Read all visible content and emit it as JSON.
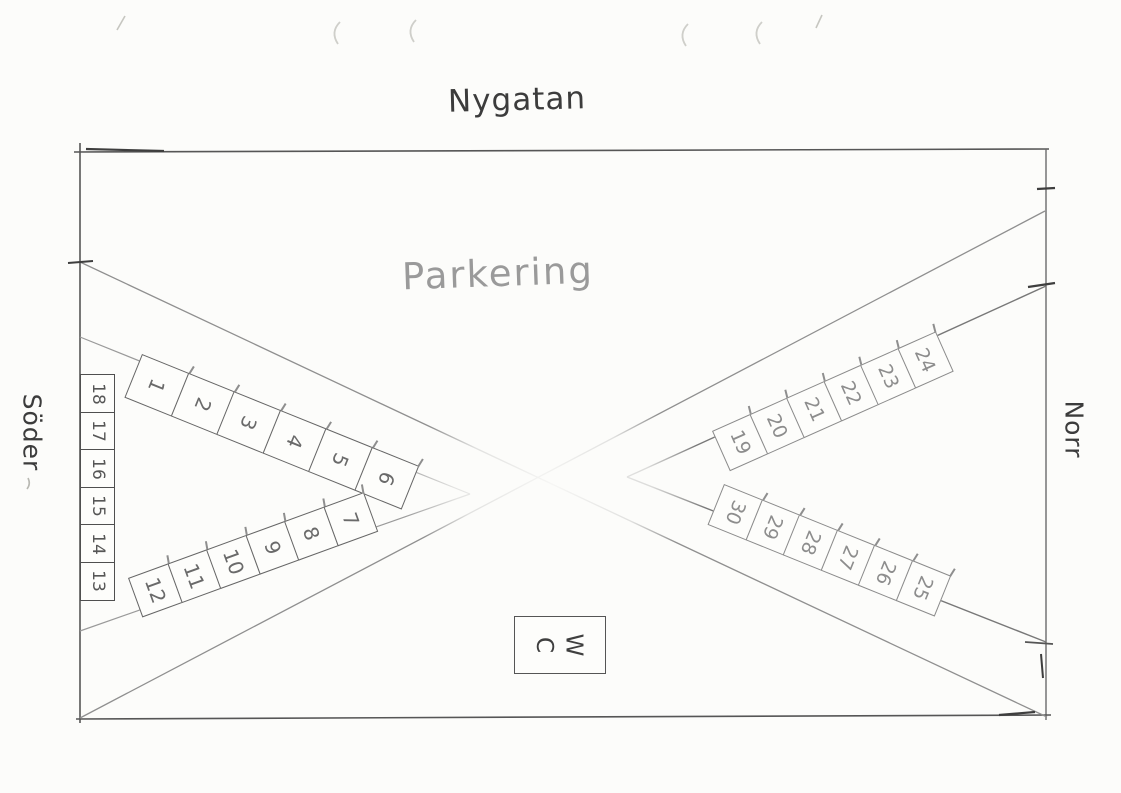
{
  "labels": {
    "street_top": "Nygatan",
    "area_center": "Parkering",
    "side_left": "Söder",
    "side_right": "Norr"
  },
  "wc_sign": {
    "letters": [
      "W",
      "C"
    ]
  },
  "parking_spaces": {
    "upper_left_row": [
      "1",
      "2",
      "3",
      "4",
      "5",
      "6"
    ],
    "lower_left_row": [
      "12",
      "11",
      "10",
      "9",
      "8",
      "7"
    ],
    "left_column": [
      "18",
      "17",
      "16",
      "15",
      "14",
      "13"
    ],
    "upper_right_row": [
      "19",
      "20",
      "21",
      "22",
      "23",
      "24"
    ],
    "lower_right_row": [
      "30",
      "29",
      "28",
      "27",
      "26",
      "25"
    ]
  },
  "colors": {
    "pencil_dark": "#3f3f3f",
    "pencil_mid": "#777777",
    "pencil_light": "#aaaaaa",
    "paper": "#fcfcfa"
  }
}
